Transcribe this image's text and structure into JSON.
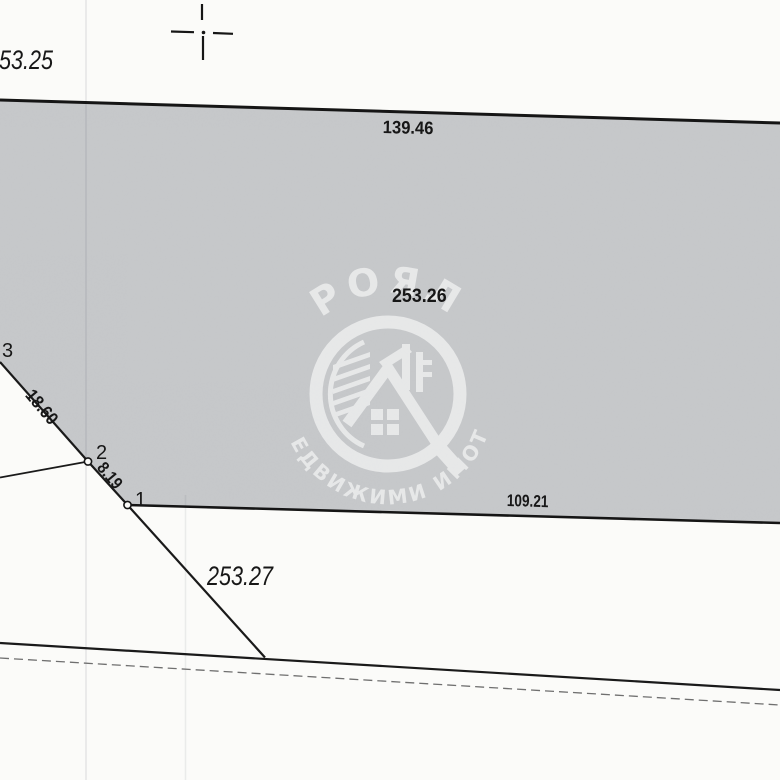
{
  "sketch": {
    "parcel_labels": {
      "upper_left": "253.25",
      "main": "253.26",
      "lower": "253.27"
    },
    "dimensions": {
      "top_side": "139.46",
      "bottom_side": "109.21",
      "side_3_to_2": "18.60",
      "side_2_to_1": "8.19"
    },
    "points": {
      "p1": "1",
      "p2": "2",
      "p3": "3"
    }
  },
  "watermark": {
    "name": "РОЯЛ",
    "tagline": "НЕДВИЖИМИ ИМОТИ"
  },
  "colors": {
    "parcel_fill": "#c7c9cb",
    "ink": "#171717",
    "paper": "#fbfbf9",
    "watermark": "#ffffff"
  }
}
